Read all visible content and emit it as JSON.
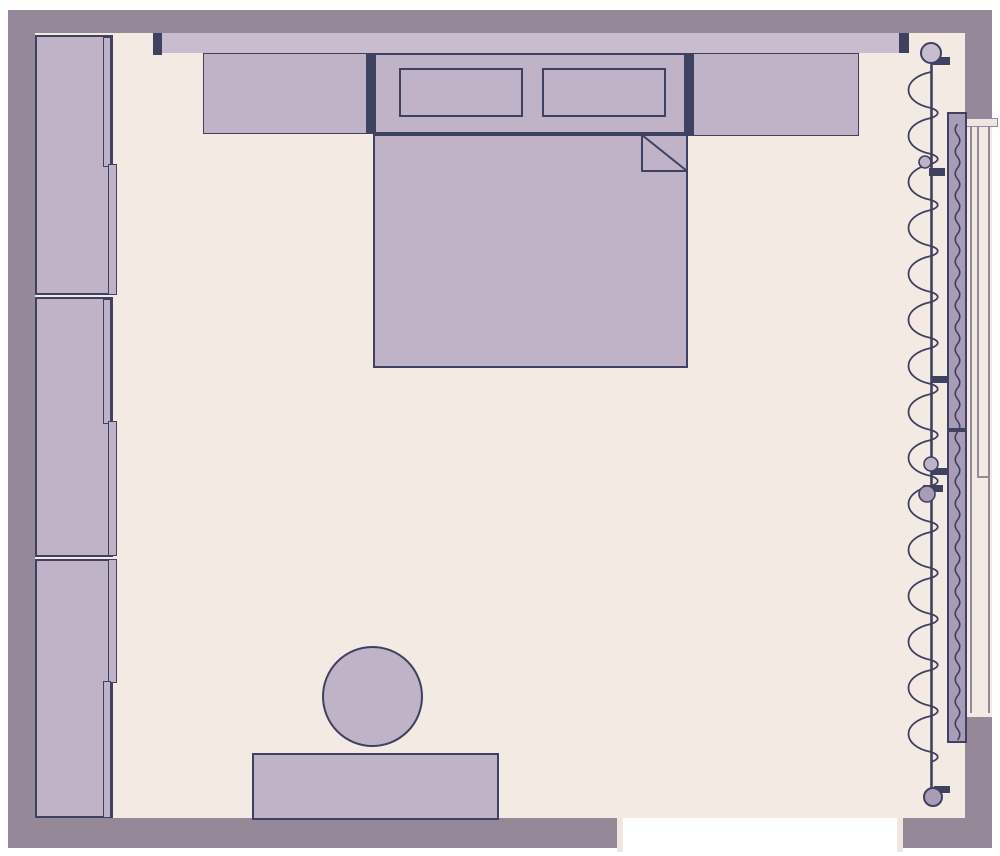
{
  "meta": {
    "title": "Bedroom Floor Plan",
    "view": "top-down floor plan",
    "visible_text": "none"
  },
  "palette": {
    "margin": "#ffffff",
    "wall": "#948899",
    "floor": "#f3eae3",
    "furniture": "#c0b3c7",
    "furniture_light": "#c8bcce",
    "curtain_band": "#a89cb6",
    "outline": "#3f4160",
    "glass_line": "#938a9b",
    "sill": "#efe7df",
    "opening": "#ffffff"
  },
  "furniture": {
    "wardrobe": {
      "label": "wardrobe",
      "modules": 3,
      "doors_per_module": 2
    },
    "pelmet": {
      "label": "curtain-pelmet-rail"
    },
    "nightstand_left": {
      "label": "nightstand"
    },
    "nightstand_right": {
      "label": "nightstand"
    },
    "bed": {
      "label": "double-bed",
      "pillows": 2,
      "blanket_fold": "top-right"
    },
    "desk": {
      "label": "desk"
    },
    "stool": {
      "label": "round-stool"
    },
    "door": {
      "label": "wall-opening"
    },
    "window": {
      "label": "window",
      "wave_x": 957.5,
      "wave_top": 124,
      "wave_half": 11,
      "wave_amp": 4.5,
      "wave_cycles": 28
    },
    "curtain": {
      "label": "curtain-rod",
      "rod_x": 931,
      "rod_top": 55,
      "rod_bottom": 796,
      "coil_top": 72,
      "coil_loops": 15,
      "coil_width": 30,
      "coil_big_h": 36,
      "coil_nub_h": 10
    }
  }
}
